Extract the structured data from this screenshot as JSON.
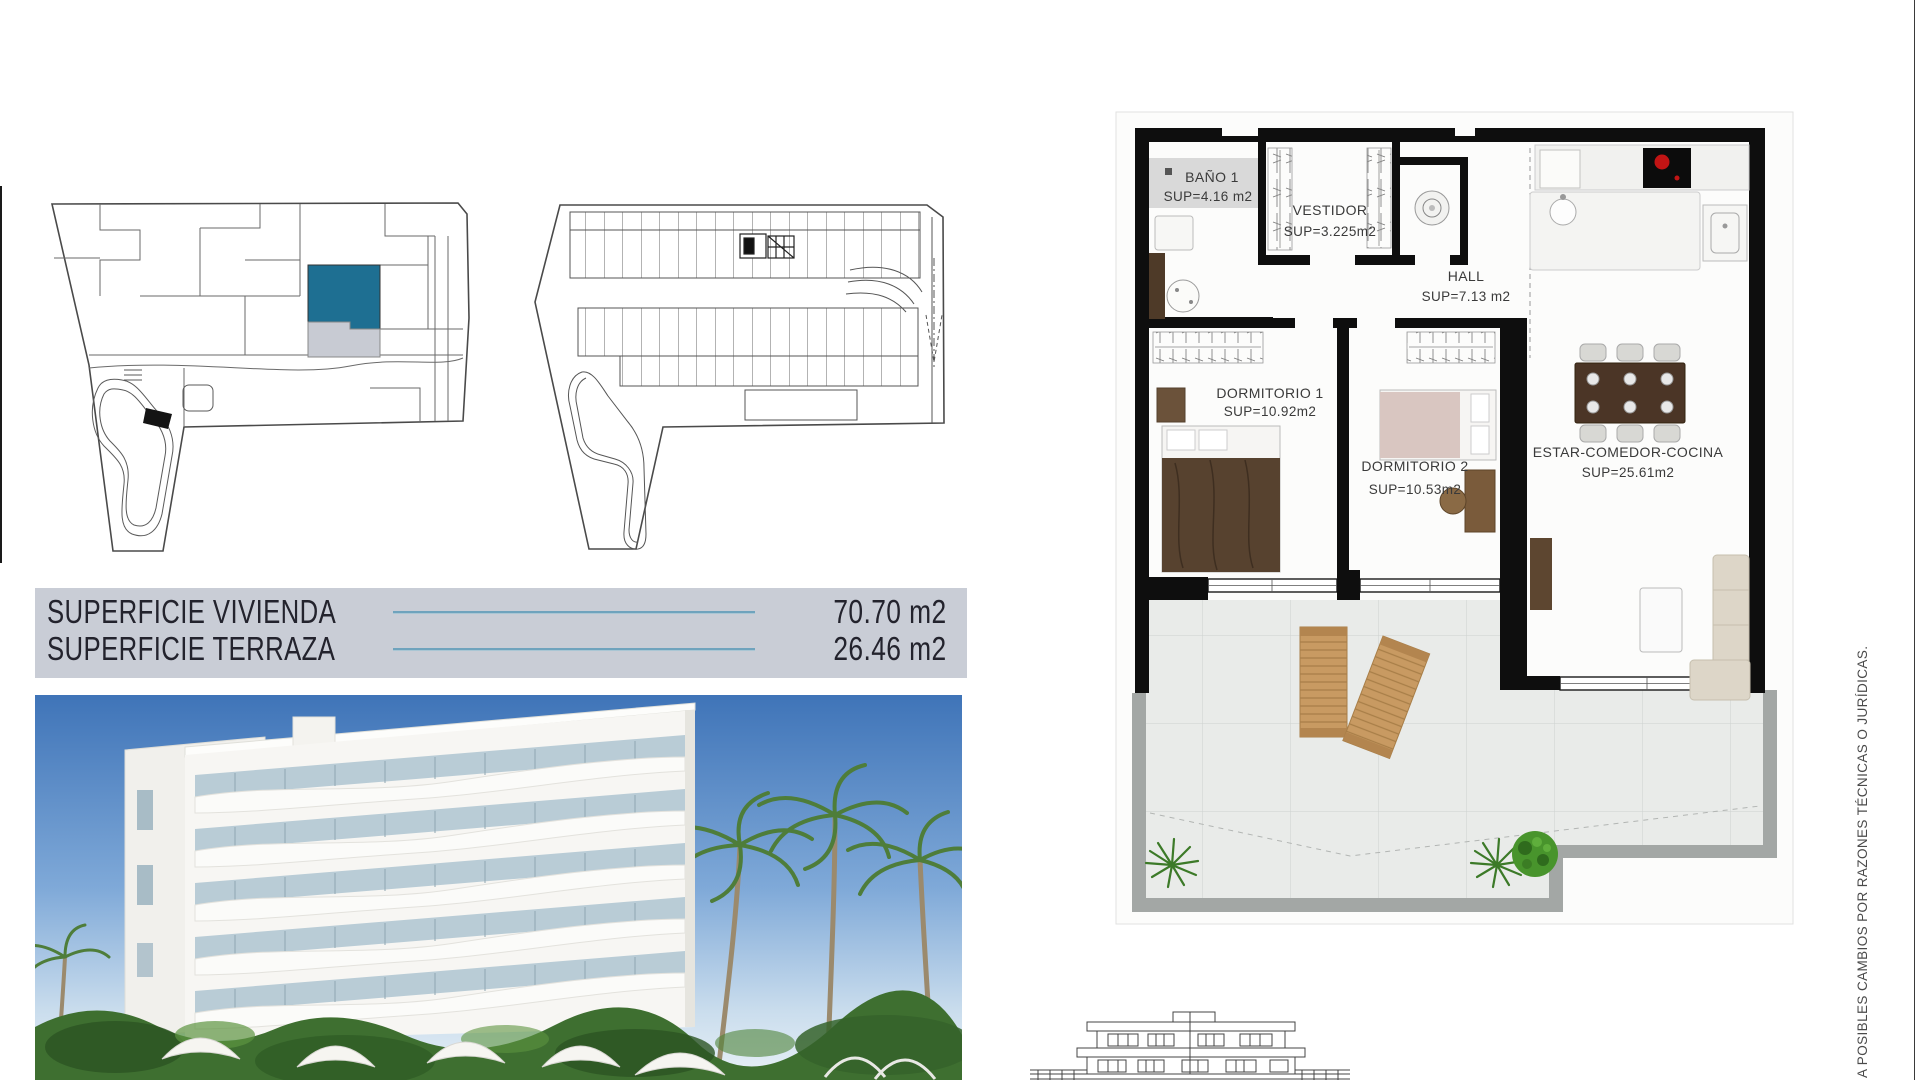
{
  "document": {
    "surface_table": {
      "rows": [
        {
          "label": "SUPERFICIE VIVIENDA",
          "value": "70.70 m2"
        },
        {
          "label": "SUPERFICIE TERRAZA",
          "value": "26.46 m2"
        }
      ]
    },
    "floor_plan": {
      "rooms": [
        {
          "name": "BAÑO 1",
          "sup": "SUP=4.16 m2"
        },
        {
          "name": "VESTIDOR",
          "sup": "SUP=3.225m2"
        },
        {
          "name": "HALL",
          "sup": "SUP=7.13 m2"
        },
        {
          "name": "DORMITORIO 1",
          "sup": "SUP=10.92m2"
        },
        {
          "name": "DORMITORIO 2",
          "sup": "SUP=10.53m2"
        },
        {
          "name": "ESTAR-COMEDOR-COCINA",
          "sup": "SUP=25.61m2"
        }
      ]
    },
    "legal_note": "A POSIBLES CAMBIOS POR RAZONES TÉCNICAS O JURÍDICAS.",
    "colors": {
      "highlight_unit": "#1e6f92",
      "table_bg": "#c9cdd6",
      "table_rule": "#6fa3bd"
    }
  }
}
